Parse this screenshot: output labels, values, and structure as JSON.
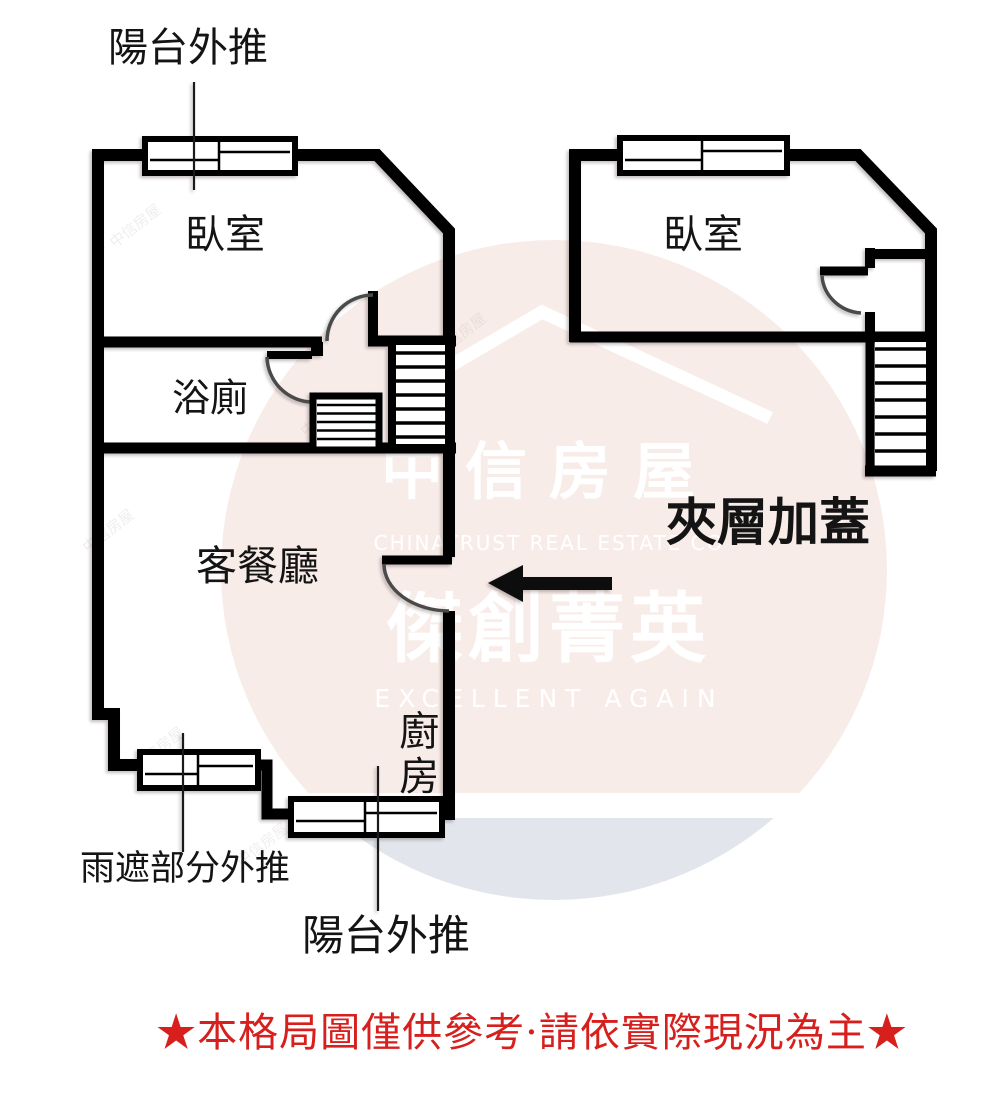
{
  "colors": {
    "watermark_pink": "#f8ece9",
    "watermark_gray": "#e2e6ec",
    "disclaimer_red": "#d7201d",
    "wall_black": "#000000",
    "label_ink": "#141414",
    "watermark_white": "#ffffff"
  },
  "icons": {
    "arrow": "arrow-left-icon",
    "roof": "roof-watermark-icon",
    "windows": "window-icon",
    "stairs": "stairs-icon",
    "door": "door-swing-icon"
  },
  "labels": {
    "balcony_push_top": "陽台外推",
    "bedroom_left": "臥室",
    "bathroom": "浴廁",
    "living_dining": "客餐廳",
    "kitchen": "廚房",
    "rain_shelter_push": "雨遮部分外推",
    "balcony_push_bottom": "陽台外推",
    "bedroom_right": "臥室",
    "mezzanine_note": "夾層加蓋"
  },
  "watermark": {
    "brand": "中信房屋",
    "brand_en": "CHINATRUST REAL ESTATE CO",
    "slogan": "傑創菁英",
    "slogan_en": "EXCELLENT AGAIN",
    "tile_text": "中信房屋"
  },
  "disclaimer": {
    "text": "★本格局圖僅供參考·請依實際現況為主★"
  }
}
